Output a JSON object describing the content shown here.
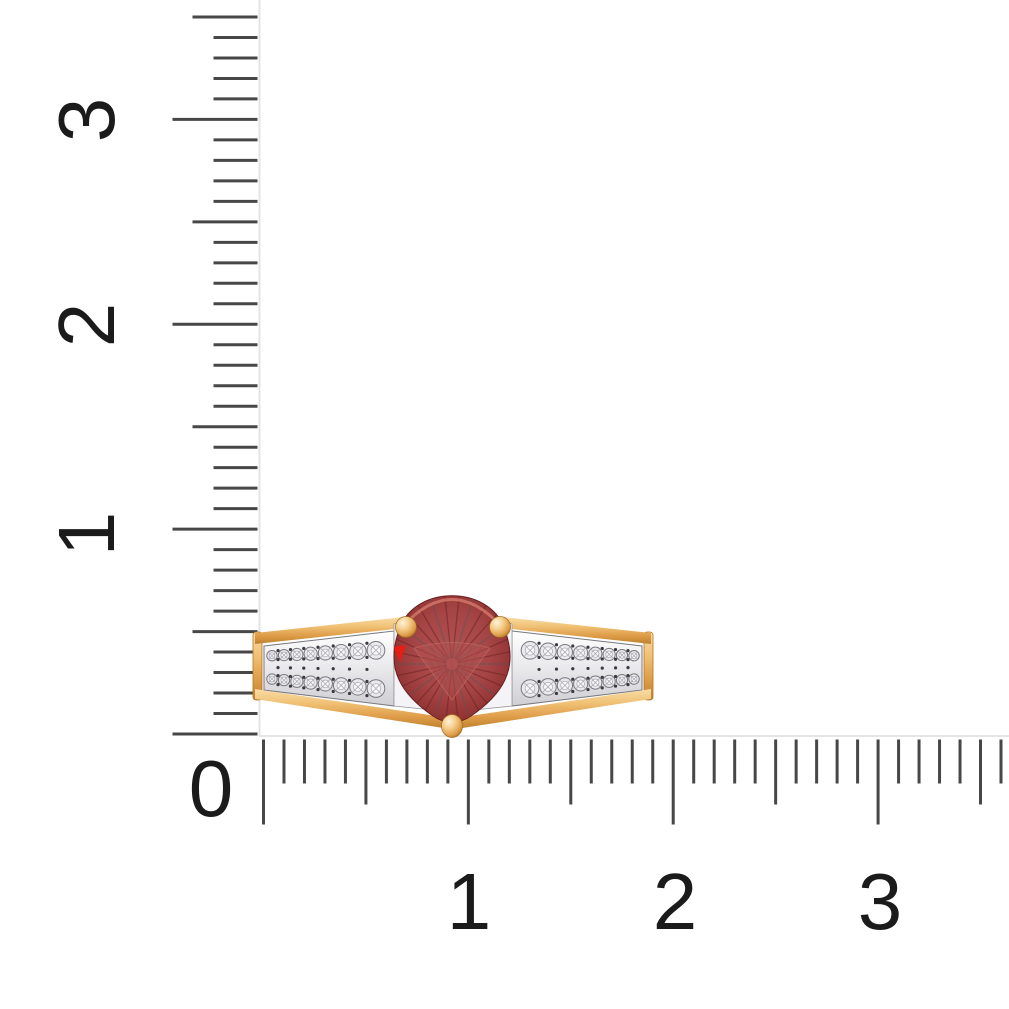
{
  "background_color": "#ffffff",
  "ruler": {
    "labels": {
      "vertical": [
        "3",
        "2",
        "1"
      ],
      "origin": "0",
      "horizontal": [
        "1",
        "2",
        "3"
      ]
    },
    "scale": {
      "origin_x": 263.5,
      "origin_y": 734,
      "px_per_unit": 204.86,
      "minor_per_unit": 10,
      "vertical_tick_count": 36,
      "horizontal_tick_count": 37
    },
    "tick_color": "#474747",
    "edge_line_color": "#e4e4e4",
    "label_color": "#1b1b1b"
  },
  "ring": {
    "colors": {
      "gold_light": "#fdf3da",
      "gold": "#f0c175",
      "gold_mid": "#de9c48",
      "gold_dark": "#b3761f",
      "metal_white": "#f4f4f6",
      "metal_edge": "#77777e",
      "diamond": "#eaeaed",
      "diamond_inner": "#f7f7f9",
      "diamond_line": "#a6a6af",
      "bead": "#3a3a40",
      "stone_red_light": "#b35555",
      "stone_red": "#a64545",
      "stone_red_dark": "#8c2f2f",
      "stone_red_deep": "#5f1d1d",
      "stone_slate": "#4a585f",
      "stone_rim": "#d4796b",
      "stone_accent": "#ee1c0f"
    }
  }
}
